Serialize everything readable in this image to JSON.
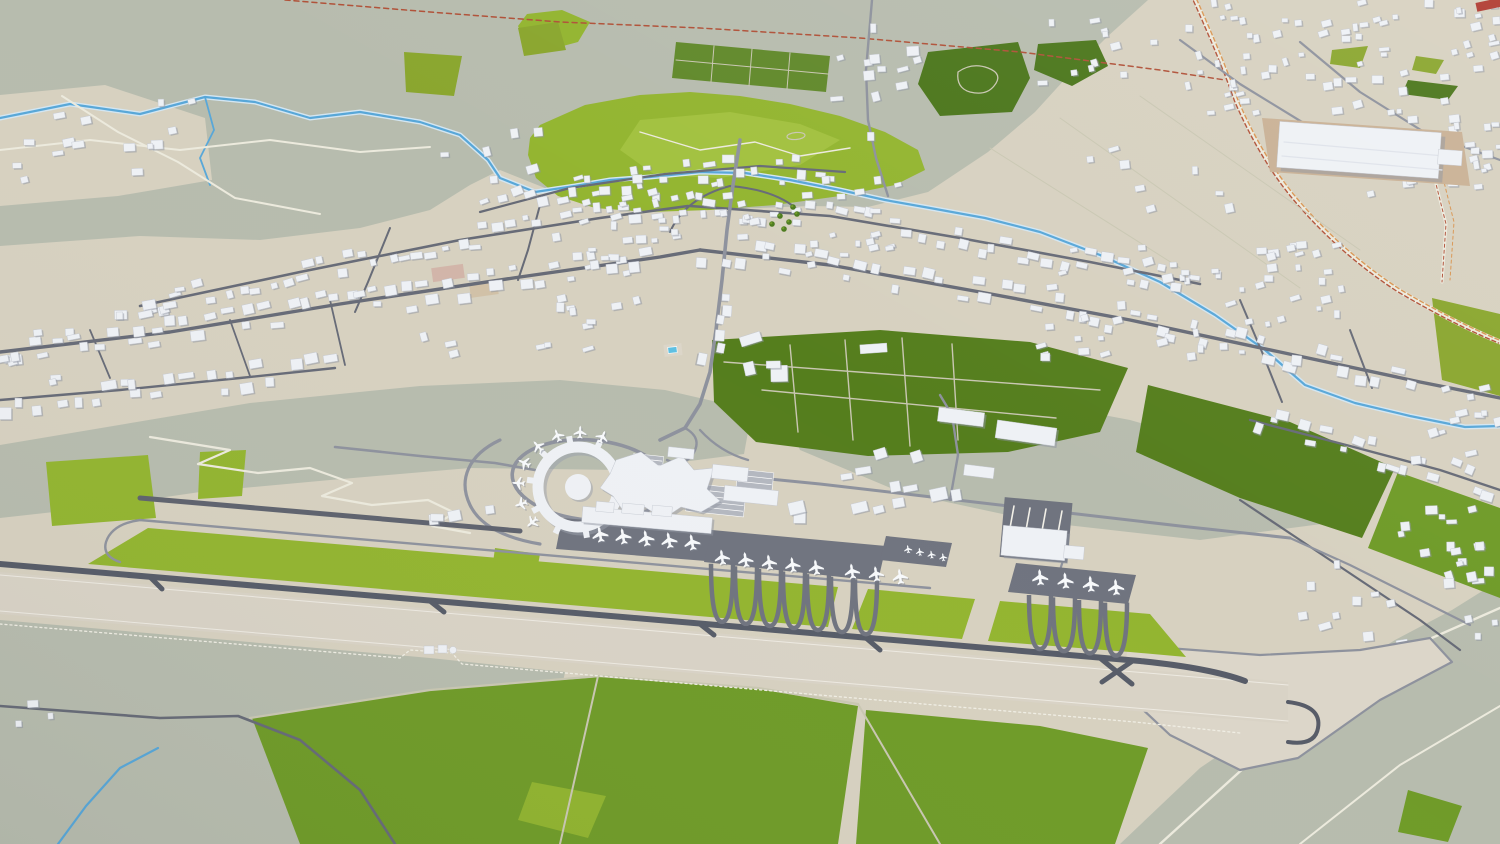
{
  "meta": {
    "description": "Low-poly 3D aerial render of a regional airport and surrounding town: one diagonal runway with bright grass infields, a circular satellite concourse linked to a star-shaped terminal, gate pier with parked airliners, remote stands, cargo sheds and a maintenance hangar; dense low-rise town across the upper half with a river, railway lines, farm fields, parks and forest patches",
    "visible_text": "none"
  },
  "palette": {
    "terrain_beige": "#d7d1c0",
    "terrain_green_gray": "#b7bcae",
    "pavement_light": "#dcd6c9",
    "runway_surface": "#d9d3c6",
    "road_dark": "#676b77",
    "road_medium": "#8e929d",
    "road_light": "#eceadd",
    "path_pale": "#c9c7b2",
    "taxiway_dark": "#575c68",
    "apron_dark": "#70747f",
    "apron_light": "#b4b8c0",
    "grass_bright": "#93b530",
    "grass_light": "#a2c13f",
    "grass_medium": "#6f9b28",
    "grass_dark": "#557e1d",
    "forest_green": "#4b761b",
    "olive_green": "#8aa62e",
    "allotment_green": "#61892b",
    "water_blue": "#58a7d8",
    "water_halo": "#d3e6f2",
    "rail_red": "#b05138",
    "rail_orange": "#d89552",
    "building_white": "#eef1f5",
    "building_shadow": "#8e93a0",
    "building_stroke": "#c2c6cf",
    "roof_red": "#b03a30",
    "dirt_tan": "#cfbb9d",
    "dirt_pink": "#d0a9a0",
    "warehouse_apron": "#c9b195",
    "pool_blue": "#5fc0e2",
    "fence_light": "#f0eee4",
    "plane_body": "#f7f9fb",
    "plane_shadow": "#7d8290",
    "tree_green": "#4c7a1e"
  },
  "scene": {
    "airport": {
      "runways": 1,
      "satellite_ring_concourse": 1,
      "main_terminal": 1,
      "gate_pier": 1,
      "parked_airliners": 25,
      "light_aircraft": 4,
      "aircraft_stand_rows": 3,
      "hangars": 2,
      "cargo_sheds": 3,
      "car_parks": 4,
      "grass_infield_sections": 3
    },
    "town": {
      "approx_buildings": 620,
      "dense_clusters": 8,
      "large_warehouse": 1,
      "red_roof_buildings": 1,
      "swimming_pool": 1
    },
    "landscape": {
      "rivers": 1,
      "streams": 2,
      "railway_corridors": 2,
      "parks_and_fields": 9,
      "forest_patches": 2,
      "allotment_gardens": 1
    }
  }
}
